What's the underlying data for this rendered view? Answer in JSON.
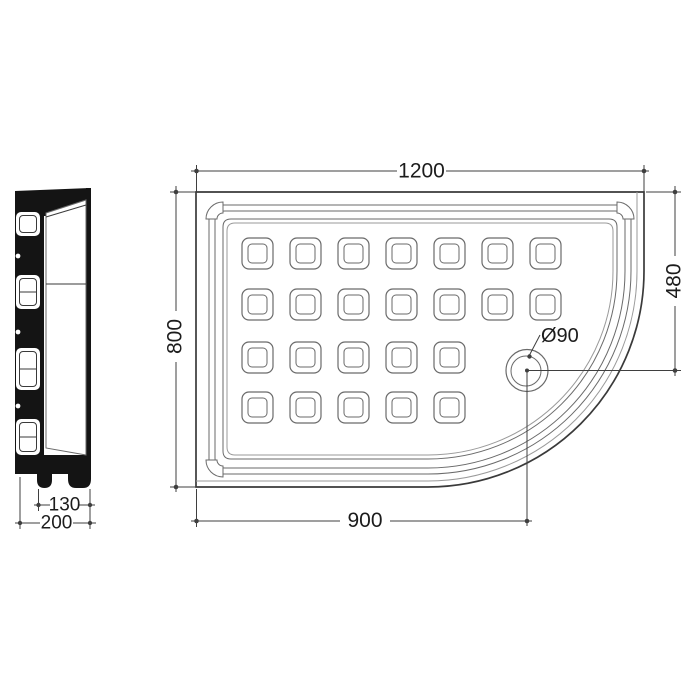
{
  "view": {
    "side_profile": {
      "dim_inner": "130",
      "dim_outer": "200"
    },
    "top": {
      "dim_width": "1200",
      "dim_depth": "800",
      "dim_drain_from_left": "900",
      "dim_drain_from_top": "480",
      "dim_drain_diameter": "Ø90",
      "anti_slip_rows": [
        7,
        7,
        5,
        5
      ]
    }
  },
  "colors": {
    "background": "#ffffff",
    "line": "#6a6a6a",
    "line-strong": "#3a3a3a",
    "dim": "#3f3f3f",
    "text": "#1c1c1c",
    "silhouette": "#141414"
  }
}
